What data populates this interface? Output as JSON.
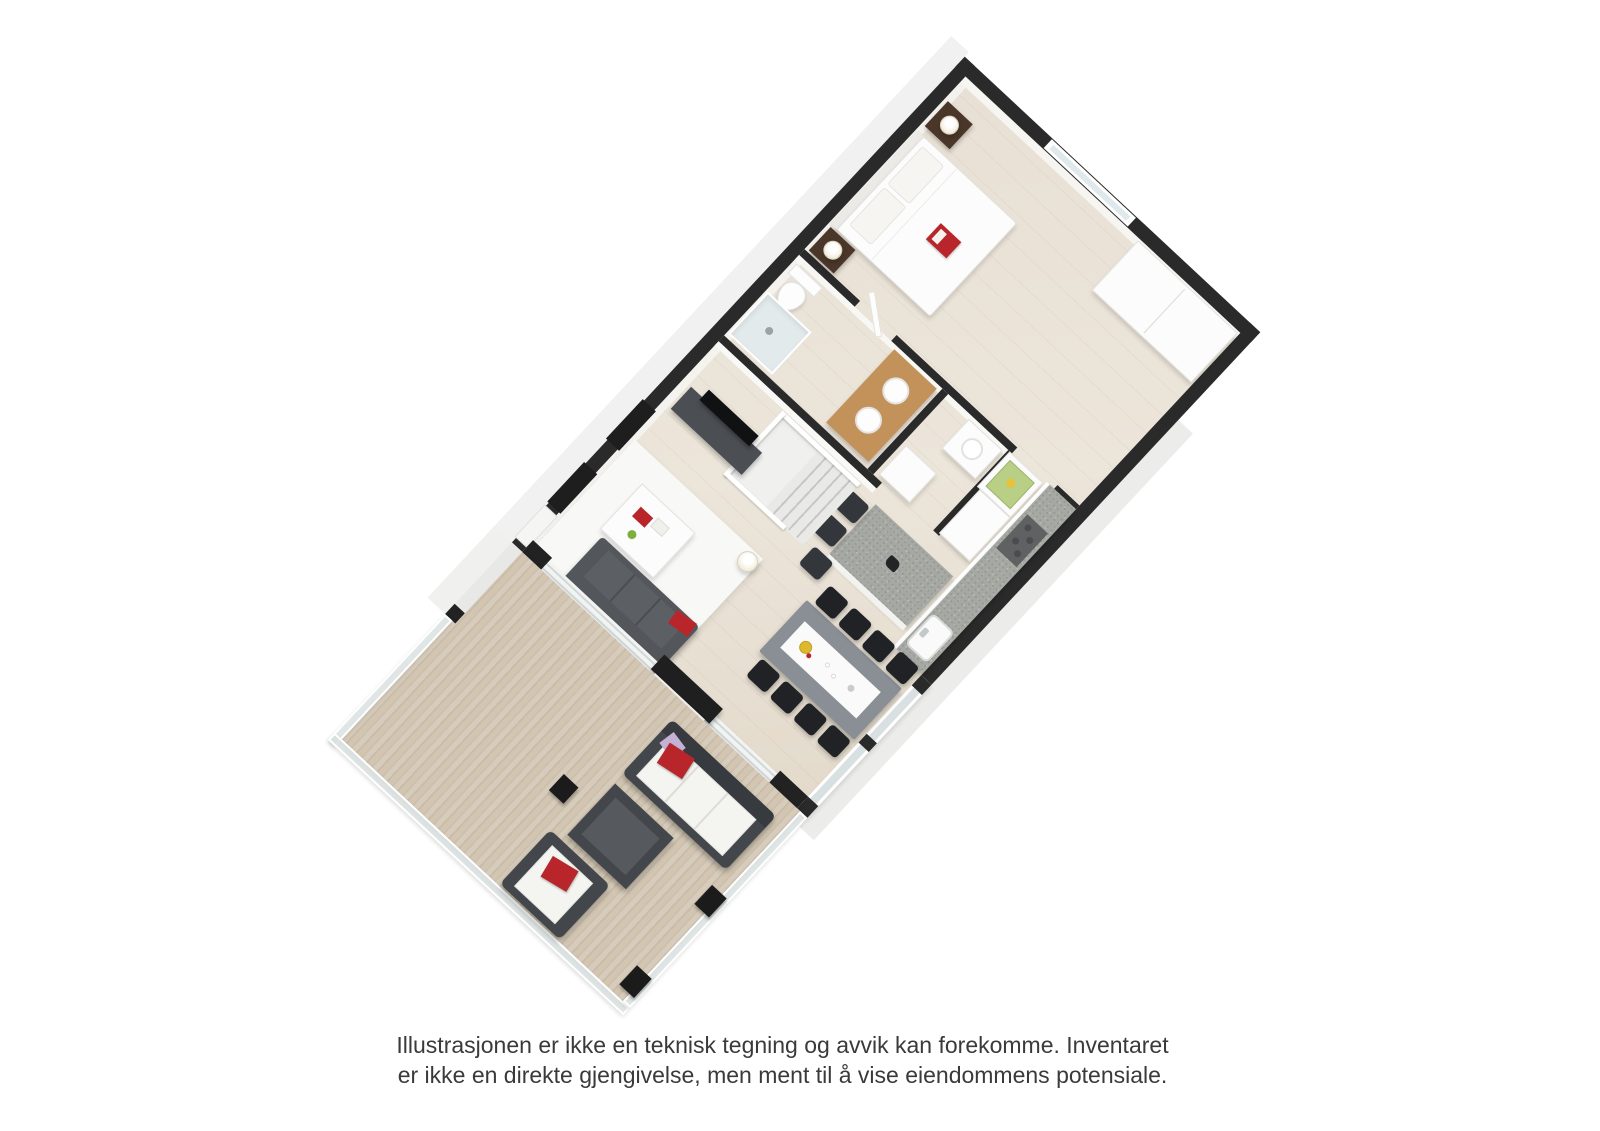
{
  "type": "3d-floor-plan-illustration",
  "disclaimer": {
    "line1": "Illustrasjonen er ikke en teknisk tegning og avvik kan forekomme. Inventaret",
    "line2": "er ikke en direkte gjengivelse, men ment til å vise eiendommens potensiale."
  },
  "colors": {
    "wall": "#2a2a2a",
    "floor": "#e8e0d4",
    "deck": "#d7ccbb",
    "deck_stripe": "#c9bda9",
    "face": "#f1f1f1",
    "granite": "#a6a8a3",
    "cooktop": "#5f6162",
    "red": "#b8262b",
    "glass": "#d9e0e2",
    "frame": "#ffffff",
    "rattan": "#43474b",
    "rattan_dark": "#33363a",
    "wood_dark": "#4a3729",
    "oak": "#c2925a",
    "sofa": "#53575c",
    "table_gray": "#8a8f95",
    "chair": "#202225",
    "white": "#fcfcfc",
    "rug": "#f8f8f6",
    "lavender": "#c3b2d6",
    "green": "#b9cf86",
    "text": "#3a3a3a"
  },
  "plan": {
    "rotation_deg": 43,
    "rooms": [
      {
        "name": "bedroom",
        "furniture": [
          "double-bed",
          "headboard",
          "pillows",
          "red-book",
          "nightstand-left",
          "nightstand-right",
          "table-lamps",
          "dresser",
          "window"
        ]
      },
      {
        "name": "bathroom",
        "furniture": [
          "toilet",
          "shower",
          "oak-vanity",
          "double-vessel-sinks",
          "open-door"
        ]
      },
      {
        "name": "wc",
        "furniture": [
          "sink-cabinet",
          "cabinet"
        ]
      },
      {
        "name": "corridor",
        "furniture": [
          "display-cabinet",
          "cabinet-row"
        ]
      },
      {
        "name": "kitchen",
        "furniture": [
          "granite-island",
          "bar-stools",
          "granite-wall-counter",
          "cooktop",
          "sink"
        ]
      },
      {
        "name": "stairwell",
        "furniture": [
          "stair-opening",
          "white-railing",
          "steps"
        ]
      },
      {
        "name": "living-room",
        "furniture": [
          "tv-bench",
          "tv",
          "rug",
          "coffee-table",
          "sofa",
          "floor-lamp"
        ]
      },
      {
        "name": "dining-area",
        "furniture": [
          "dining-table",
          "table-runner",
          "fruit-bowl",
          "eight-black-chairs",
          "glass-wall"
        ]
      },
      {
        "name": "terrace",
        "furniture": [
          "wood-deck",
          "glass-railing",
          "outdoor-sofa",
          "rattan-table",
          "lounge-chair",
          "red-pillows",
          "planters",
          "privacy-screen"
        ]
      }
    ]
  }
}
